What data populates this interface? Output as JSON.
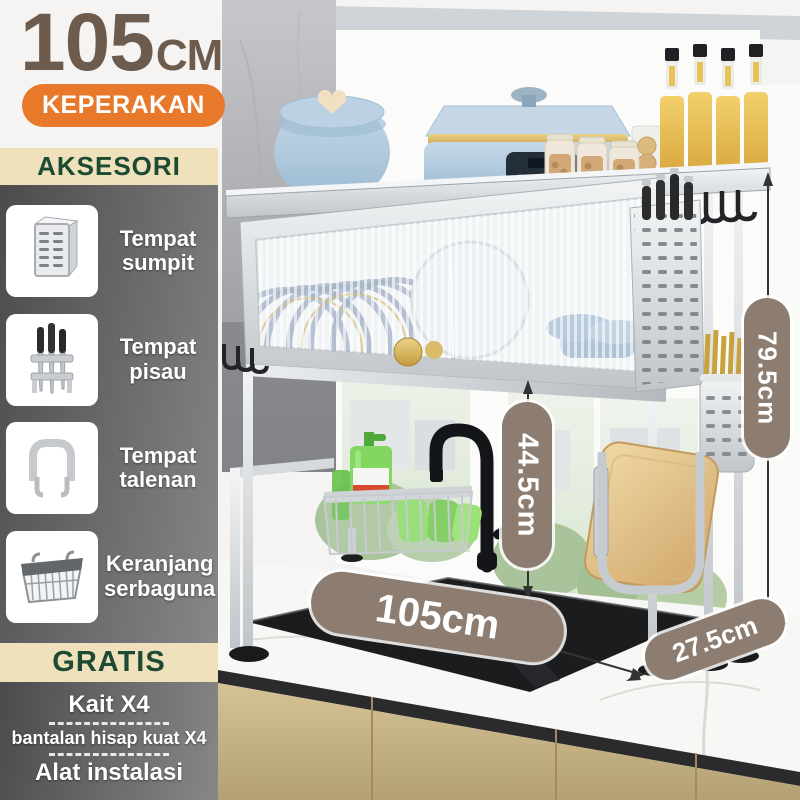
{
  "product": {
    "size_value": "105",
    "size_unit": "CM",
    "variant": "KEPERAKAN"
  },
  "sidebar": {
    "accessories_title": "AKSESORI",
    "accessories": [
      {
        "label": "Tempat sumpit",
        "icon": "chopstick-holder-icon"
      },
      {
        "label": "Tempat pisau",
        "icon": "knife-holder-icon"
      },
      {
        "label": "Tempat talenan",
        "icon": "cutting-board-hook-icon"
      },
      {
        "label": "Keranjang serbaguna",
        "icon": "wire-basket-icon"
      }
    ],
    "free_title": "GRATIS",
    "free_items": [
      "Kait X4",
      "bantalan hisap kuat X4",
      "Alat instalasi"
    ]
  },
  "dimensions": {
    "total_height": "79.5cm",
    "clearance_height": "44.5cm",
    "width": "105cm",
    "depth": "27.5cm"
  },
  "colors": {
    "accent_orange": "#E8792B",
    "header_beige": "#EEE1BC",
    "header_green": "#1C4A33",
    "title_brown": "#6D5B4E",
    "dimension_pill": "#8D7C70"
  }
}
